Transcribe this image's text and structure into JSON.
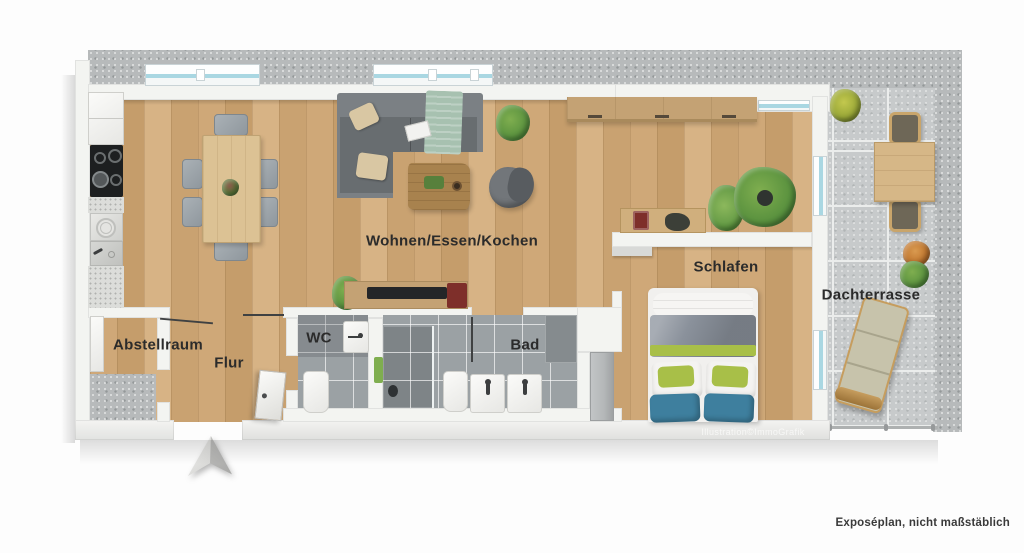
{
  "rooms": {
    "living": {
      "label": "Wohnen/Essen/Kochen"
    },
    "sleeping": {
      "label": "Schlafen"
    },
    "terrace": {
      "label": "Dachterrasse"
    },
    "storage": {
      "label": "Abstellraum"
    },
    "hallway": {
      "label": "Flur"
    },
    "wc": {
      "label": "WC"
    },
    "bathroom": {
      "label": "Bad"
    }
  },
  "annotations": {
    "watermark": "Illustration©ImmoGrafik",
    "disclaimer": "Exposéplan, nicht maßstäblich"
  },
  "colors": {
    "wood": "#cfa878",
    "wood2": "#c59d6b",
    "wood3": "#d7b385",
    "wood4": "#c9a271",
    "wall": "#f3f4f1",
    "walledge": "#d8d9d5",
    "concrete": "#b7babb",
    "tile": "#c7cacb",
    "grout": "#ebedec",
    "bath": "#9ba1a4",
    "bathdark": "#858b8e",
    "shower": "#7e8487",
    "sofa": "#7b8084",
    "sofadeep": "#686d70",
    "pillow": "#d9c7a3",
    "blanket": "#a7c1b0",
    "coffeetable": "#a8824e",
    "beanbag": "#72767a",
    "dtable": "#dcc294",
    "cabwood": "#c4a274",
    "deskwood": "#d0af7d",
    "mattress": "#f1f0ee",
    "duvet": "#8a919b",
    "bedgreen": "#a8bf48",
    "bedblue": "#3e7f9e",
    "closet": "#b4b7b8",
    "ttable": "#d6b787",
    "tchairseat": "#6e6757",
    "tchairframe": "#c9a56b",
    "lounger": "#c7c3ab",
    "loungerframe": "#c69d5e",
    "green1": "#5d9440",
    "green2": "#7fae4f",
    "green3": "#3f7a33",
    "potdark": "#2f3430",
    "labelcolor": "#2b2b2b",
    "cooktop": "#1d1f20",
    "speckle": "#dcddda",
    "redappliance": "#7e2f2a",
    "tvblack": "#242628",
    "winglass": "#a9d7e2",
    "winframe": "#c9d3d6"
  }
}
